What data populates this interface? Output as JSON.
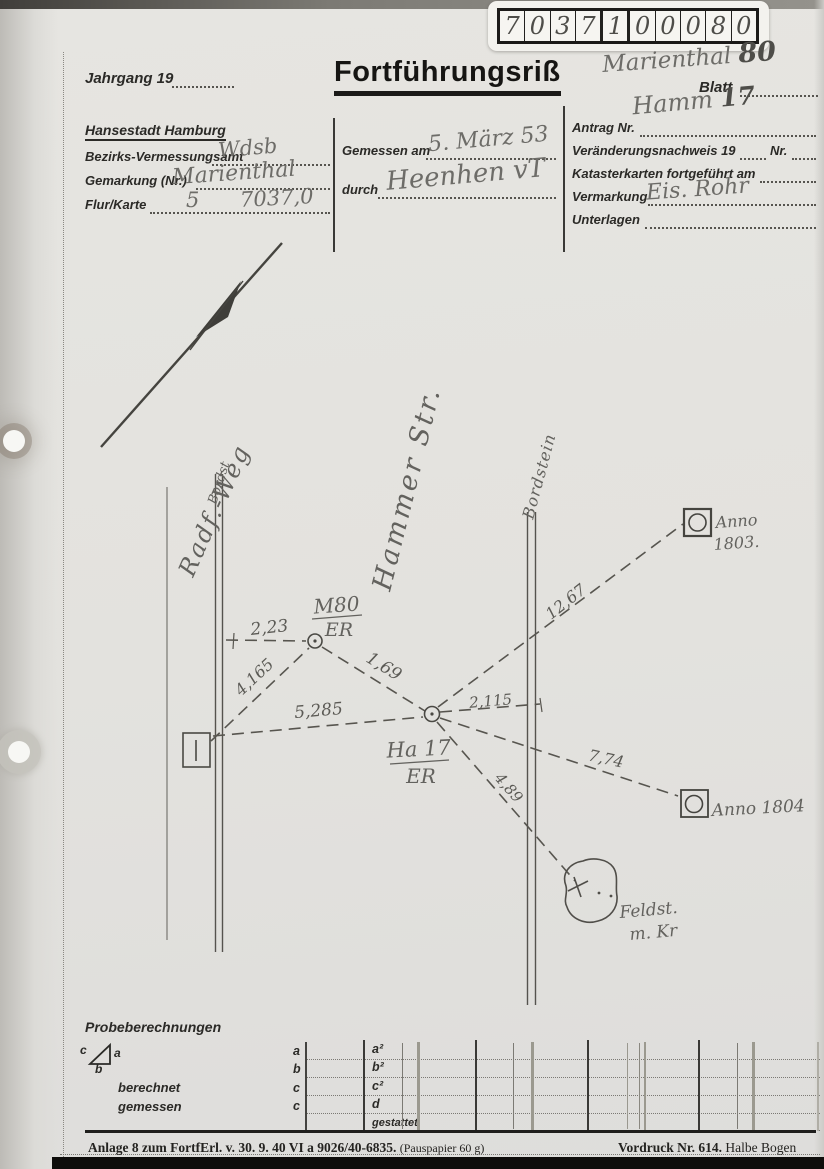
{
  "label_box": {
    "digits": [
      "7",
      "0",
      "3",
      "7",
      "1",
      "0",
      "0",
      "0",
      "8",
      "0"
    ]
  },
  "header": {
    "jahrgang_label": "Jahrgang 19",
    "title": "Fortführungsriß",
    "blatt_label": "Blatt",
    "annotation_gemarkung": "Marienthal",
    "annotation_gemarkung_nr": "80",
    "annotation_blatt": "Hamm",
    "annotation_blatt_nr": "17"
  },
  "form": {
    "left": {
      "heading": "Hansestadt Hamburg",
      "amt_label": "Bezirks-Vermessungsamt",
      "amt_value": "Wdsb",
      "gemarkung_label": "Gemarkung (Nr.)",
      "gemarkung_value": "Marienthal",
      "flur_label": "Flur/Karte",
      "flur_value_1": "5",
      "flur_value_2": "7037,0"
    },
    "middle": {
      "gemessen_label": "Gemessen am",
      "gemessen_value": "5. März 53",
      "durch_label": "durch",
      "durch_value": "Heenhen  vT"
    },
    "right": {
      "antrag_label": "Antrag Nr.",
      "veraenderung_label": "Veränderungsnachweis 19",
      "veraenderung_nr_label": "Nr.",
      "kataster_label": "Katasterkarten fortgeführt am",
      "vermarkung_label": "Vermarkung",
      "vermarkung_value": "Eis. Rohr",
      "unterlagen_label": "Unterlagen"
    }
  },
  "sketch": {
    "streets": {
      "radf_weg": "Radf.-Weg",
      "bordst": "Bordst",
      "hammer_str": "Hammer Str.",
      "bordstein": "Bordstein"
    },
    "points": {
      "m80_top": "M80",
      "m80_bottom": "ER",
      "ha17_top": "Ha 17",
      "ha17_bottom": "ER",
      "anno1803_line1": "Anno",
      "anno1803_line2": "1803.",
      "anno1804": "Anno 1804",
      "feldstein_line1": "Feldst.",
      "feldstein_line2": "m. Kr"
    },
    "measurements": {
      "m1": "2,23",
      "m2": "4,165",
      "m3": "5,285",
      "m4": "1,69",
      "m5": "2,115",
      "m6": "12,67",
      "m7": "7,74",
      "m8": "4,89"
    }
  },
  "probe": {
    "title": "Probeberechnungen",
    "triangle": {
      "a": "a",
      "b": "b",
      "c": "c"
    },
    "berechnet_label": "berechnet",
    "gemessen_label": "gemessen",
    "col_letters": {
      "r1": "a",
      "r2": "b",
      "r3": "c",
      "r4": "c"
    },
    "col_values": {
      "r1": "a²",
      "r2": "b²",
      "r3": "c²",
      "r4": "d",
      "r5": "gestattet"
    }
  },
  "footer": {
    "left_main": "Anlage 8 zum FortfErl. v. 30. 9. 40  VI a 9026/40-6835.",
    "left_note": "(Pauspapier 60 g)",
    "right_main": "Vordruck Nr. 614.",
    "right_note": "Halbe Bogen"
  }
}
